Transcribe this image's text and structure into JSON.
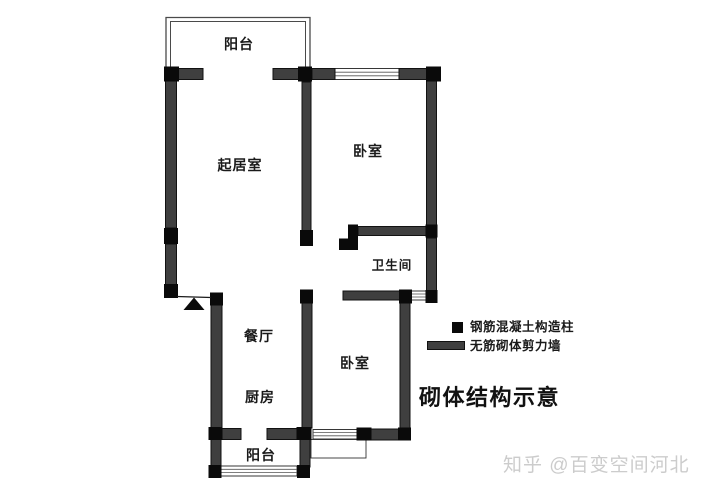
{
  "title": "砌体结构示意",
  "rooms": {
    "balcony_top": "阳台",
    "living": "起居室",
    "bedroom1": "卧室",
    "bathroom": "卫生间",
    "dining": "餐厅",
    "kitchen": "厨房",
    "bedroom2": "卧室",
    "balcony_bottom": "阳台"
  },
  "legend": {
    "column_label": "钢筋混凝土构造柱",
    "wall_label": "无筋砌体剪力墙"
  },
  "watermark": "知乎 @百变空间河北",
  "colors": {
    "wall": "#3f3f3f",
    "column": "#0a0a0a",
    "window_line": "#555555",
    "text": "#1a1a1a",
    "watermark": "#cccccc",
    "background": "#ffffff"
  }
}
